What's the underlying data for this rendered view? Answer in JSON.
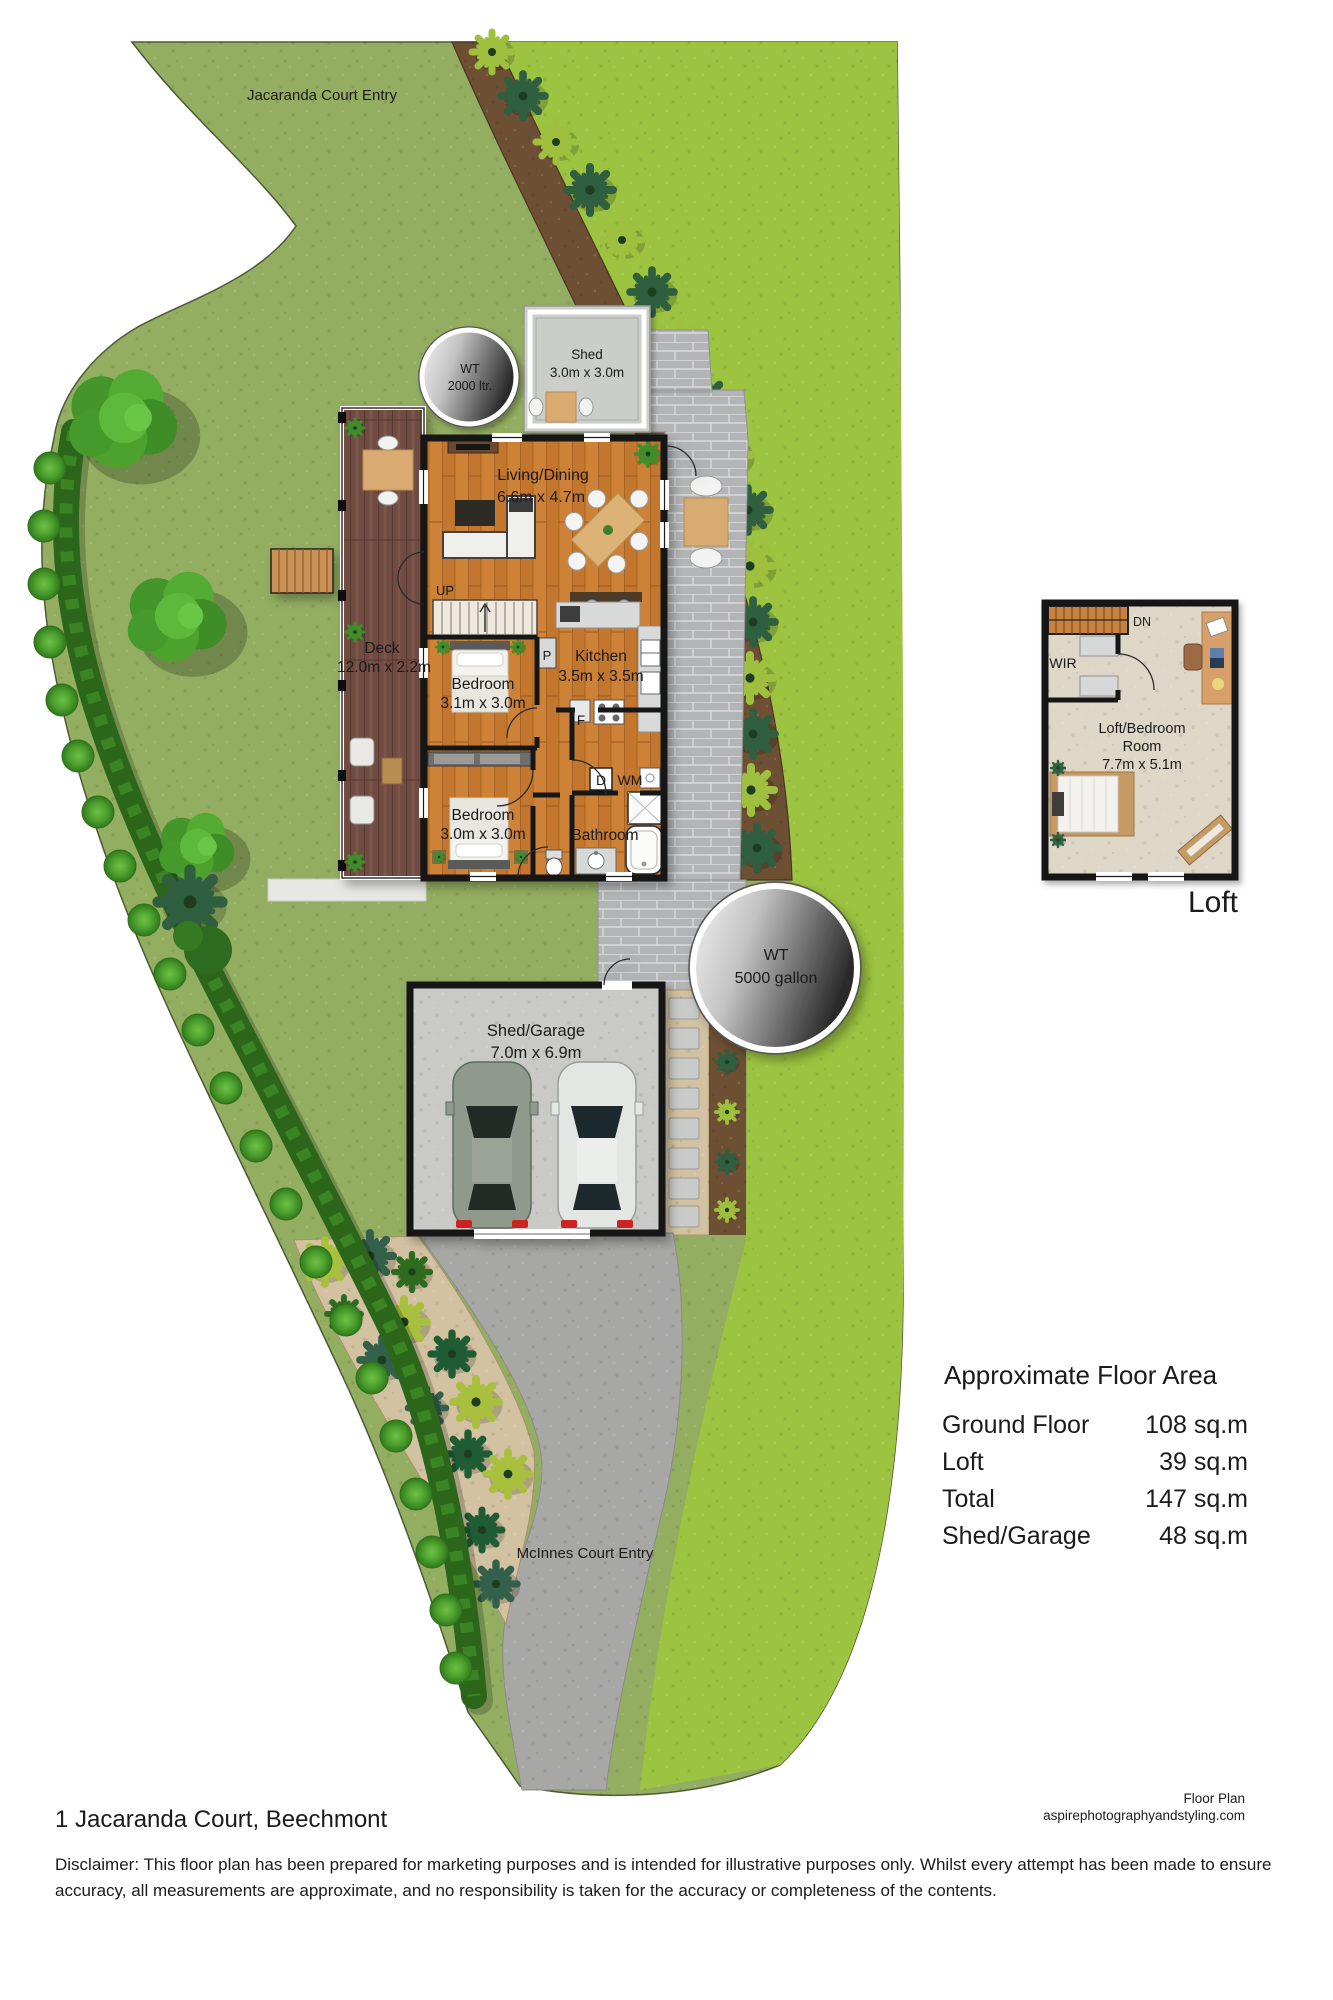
{
  "site_plan": {
    "entry_labels": {
      "top": "Jacaranda Court Entry",
      "bottom": "McInnes Court Entry"
    },
    "water_tanks": [
      {
        "line1": "WT",
        "line2": "2000 ltr."
      },
      {
        "line1": "WT",
        "line2": "5000 gallon"
      }
    ],
    "shed": {
      "name": "Shed",
      "dims": "3.0m x 3.0m"
    },
    "garage": {
      "name": "Shed/Garage",
      "dims": "7.0m x 6.9m"
    },
    "rooms": {
      "living": {
        "name": "Living/Dining",
        "dims": "6.6m x 4.7m"
      },
      "kitchen": {
        "name": "Kitchen",
        "dims": "3.5m x 3.5m"
      },
      "bedroom1": {
        "name": "Bedroom",
        "dims": "3.1m x 3.0m"
      },
      "bedroom2": {
        "name": "Bedroom",
        "dims": "3.0m x 3.0m"
      },
      "bathroom": {
        "name": "Bathroom"
      },
      "deck": {
        "name": "Deck",
        "dims": "12.0m x 2.2m"
      }
    },
    "markers": {
      "up": "UP",
      "pantry": "P",
      "fridge": "F",
      "dryer": "D",
      "washing_machine": "WM"
    }
  },
  "loft_plan": {
    "caption": "Loft",
    "room": {
      "line1": "Loft/Bedroom",
      "line2": "Room",
      "dims": "7.7m x 5.1m"
    },
    "markers": {
      "down": "DN",
      "wardrobe": "WIR"
    }
  },
  "floor_area": {
    "title": "Approximate Floor Area",
    "rows": [
      {
        "label": "Ground Floor",
        "value": "108 sq.m"
      },
      {
        "label": "Loft",
        "value": "39 sq.m"
      },
      {
        "label": "Total",
        "value": "147 sq.m"
      },
      {
        "label": "Shed/Garage",
        "value": "48 sq.m"
      }
    ]
  },
  "footer": {
    "address": "1 Jacaranda Court, Beechmont",
    "credit_line1": "Floor Plan",
    "credit_line2": "aspirephotographyandstyling.com",
    "disclaimer": "Disclaimer: This floor plan has been prepared for marketing purposes and is intended for illustrative purposes only. Whilst every attempt has been made to ensure accuracy, all measurements are approximate, and no responsibility is taken for the accuracy or completeness of the contents."
  },
  "colors": {
    "lawn_main": "#93ae61",
    "lawn_bright": "#9cc441",
    "hedge": "#2c661b",
    "soil_bed": "#6d5034",
    "mulch": "#d2c2a2",
    "driveway": "#a7a7a5",
    "paver": "#b2b4b6",
    "deck_wood": "#6f4b42",
    "floor_wood": "#c5772e",
    "loft_floor": "#ded7c8",
    "wall": "#161616",
    "water_tank_dark": "#2c2c2c",
    "car_green": "#8f998c",
    "car_white": "#e4e6e3"
  }
}
